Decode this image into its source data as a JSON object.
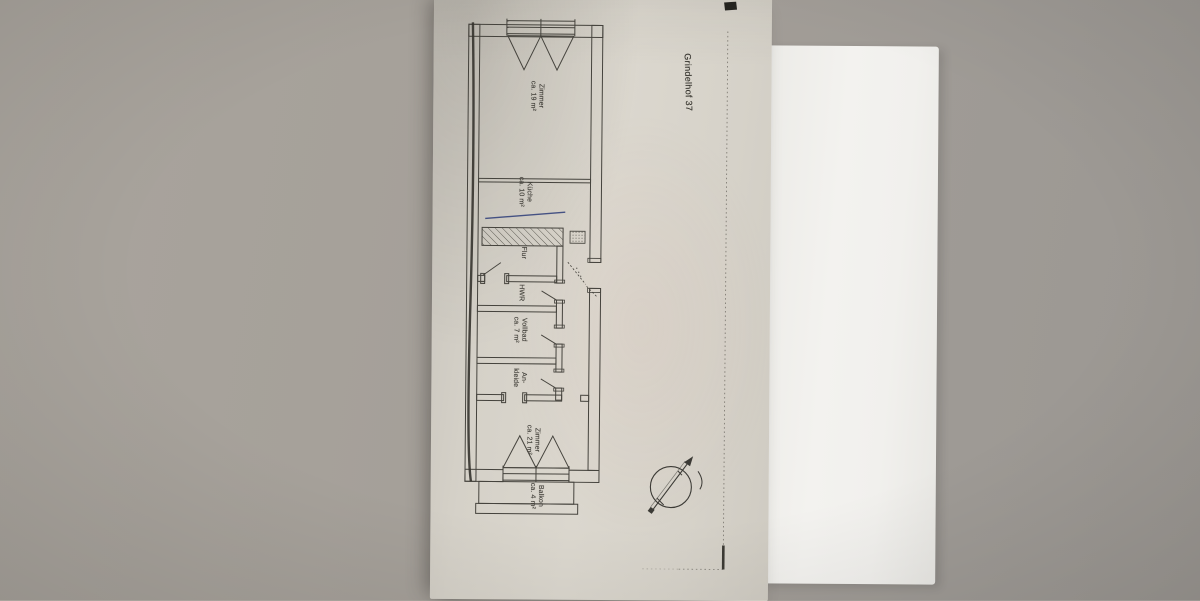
{
  "document_title": "Grindelhof 37",
  "rooms": [
    {
      "line1": "Zimmer",
      "line2": "ca. 19 m²"
    },
    {
      "line1": "Küche",
      "line2": "ca. 10 m²"
    },
    {
      "line1": "Flur",
      "line2": ""
    },
    {
      "line1": "HWR",
      "line2": ""
    },
    {
      "line1": "Vollbad",
      "line2": "ca. 7 m²"
    },
    {
      "line1": "An-",
      "line2": "kleide"
    },
    {
      "line1": "Zimmer",
      "line2": "ca. 21 m²"
    },
    {
      "line1": "Balkon",
      "line2": "ca. 4 m²"
    }
  ],
  "colors": {
    "desk": "#a5a09a",
    "plan_paper": "#d7d3ca",
    "white_sheet": "#f1f0ed",
    "ink": "#45433d",
    "pen_annotation_blue": "#31407a"
  }
}
